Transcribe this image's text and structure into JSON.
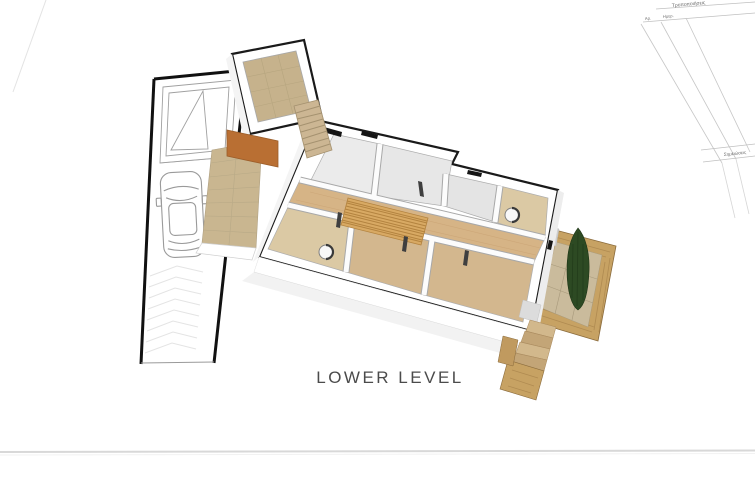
{
  "sheet": {
    "plan_label": "LOWER LEVEL"
  },
  "title_block": {
    "revisions_header": "Τροποποιήσεις",
    "col_number_label": "Αρ.",
    "col_date_label": "Ημερ.",
    "notes_header": "Σημειώσεις"
  },
  "icons": {
    "car": "car-top-view-icon",
    "ramp": "driveway-ramp-icon",
    "toilet": "toilet-fixture-icon",
    "tree": "cypress-tree-icon"
  },
  "colors": {
    "wall_outline": "#1a1a1a",
    "accent_wall": "#b96f33",
    "entry_floor": "#c6b28c",
    "walkway_floor": "#c9b690",
    "corridor_floor": "#d6b486",
    "carpet_floor": "#d3b78e",
    "bath_floor": "#dbc9a4",
    "room_floor_light": "#ebebeb",
    "stair_tread": "#d8a963",
    "upper_stair": "#ccb693",
    "brick": "#c7a263",
    "stone_floor": "#cabb9c",
    "tree": "#2d4a23",
    "drawing_line": "#9a9a9a",
    "label_text": "#4b4b4b",
    "sheet_line": "#d8d8d8",
    "title_block_line": "#c0c0c0"
  }
}
